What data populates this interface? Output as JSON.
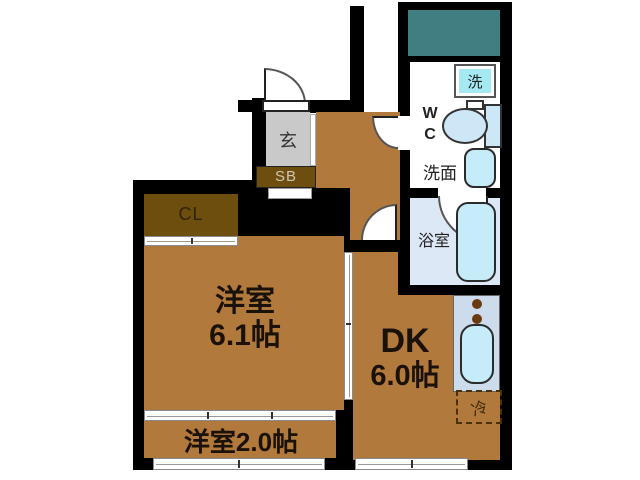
{
  "floor_plan": {
    "entrance": {
      "label": "玄"
    },
    "storage": {
      "shoe_box": {
        "label": "SB"
      },
      "closet": {
        "label": "CL"
      }
    },
    "rooms": {
      "main_room": {
        "label": "洋室",
        "size": "6.1帖"
      },
      "small_room": {
        "label": "洋室2.0帖"
      },
      "dining_kitchen": {
        "label": "DK",
        "size": "6.0帖"
      },
      "bathroom": {
        "label": "浴室"
      },
      "washroom": {
        "label": "洗面"
      },
      "toilet": {
        "label_line1": "W",
        "label_line2": "C"
      }
    },
    "fixtures": {
      "laundry_machine": {
        "label": "洗"
      },
      "refrigerator": {
        "label": "冷"
      }
    },
    "colors": {
      "wall": "#000000",
      "room_floor": "#b1793b",
      "closet_fill": "#6e4e0f",
      "entrance_floor": "#c9c9c9",
      "terrace": "#3f7e81",
      "bath_floor": "#dde8f6",
      "fixture_fill": "#c5ecf8",
      "kitchen_counter": "#cddcec",
      "burner": "#6b3a10"
    }
  }
}
